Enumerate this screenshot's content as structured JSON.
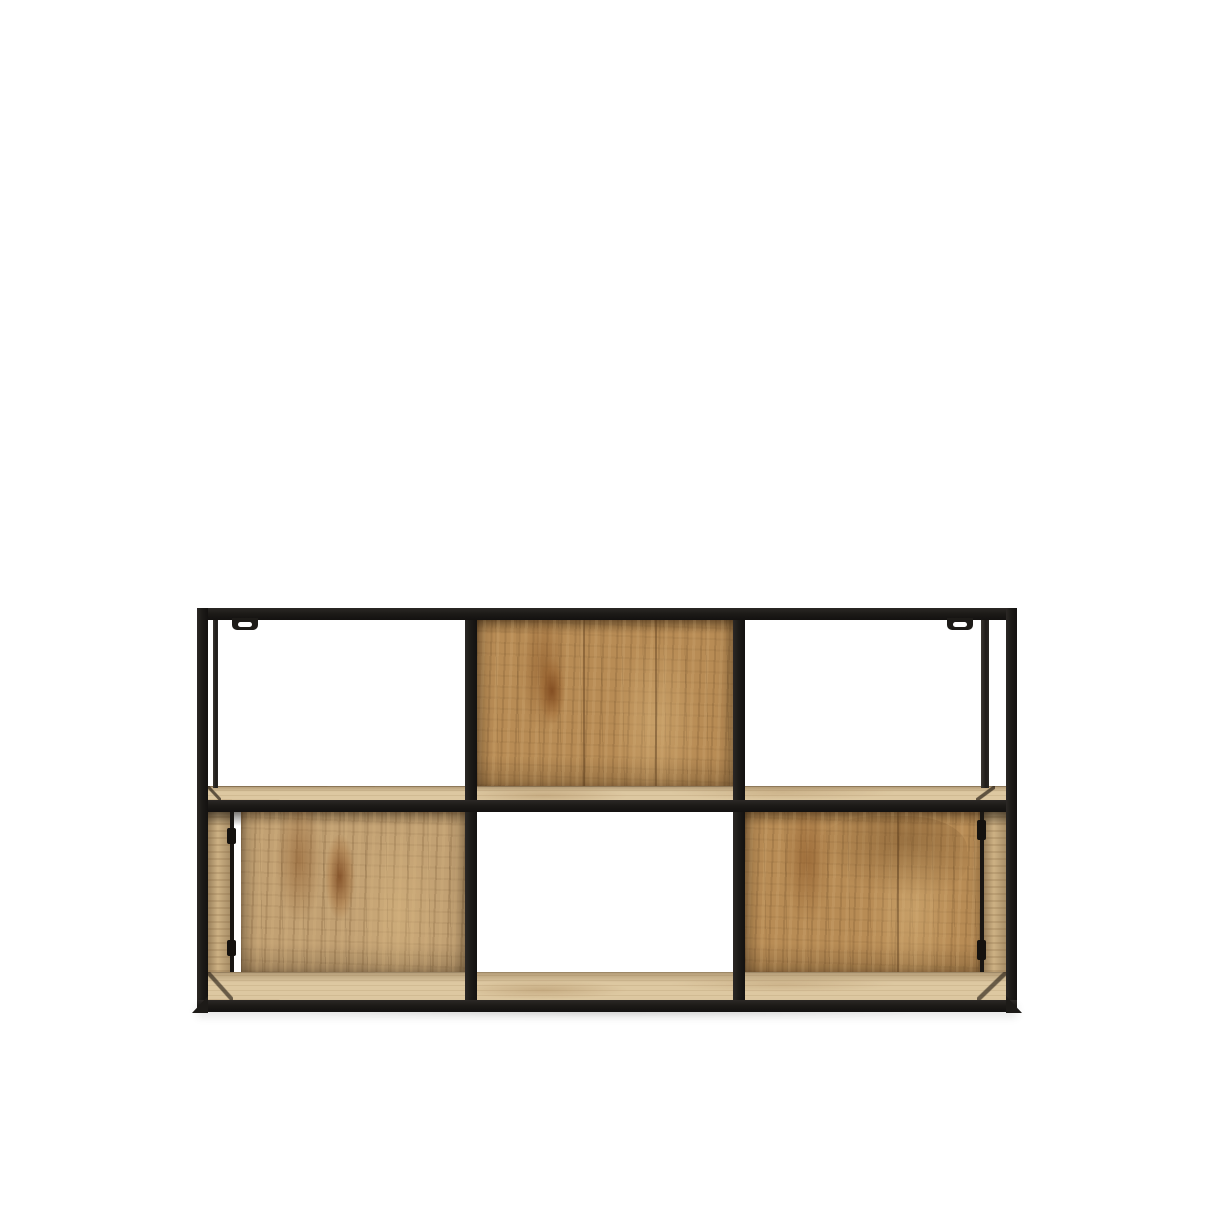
{
  "image": {
    "type": "product-photo",
    "subject": "Industrial wall shelf with black metal frame and mango wood panels",
    "background_color": "#ffffff"
  },
  "shelf": {
    "grid": {
      "columns": 3,
      "rows": 2
    },
    "cells": [
      {
        "row": 1,
        "col": 1,
        "content": "open-compartment"
      },
      {
        "row": 1,
        "col": 2,
        "content": "wood-back-panel"
      },
      {
        "row": 1,
        "col": 3,
        "content": "open-compartment"
      },
      {
        "row": 2,
        "col": 1,
        "content": "wood-box-compartment"
      },
      {
        "row": 2,
        "col": 2,
        "content": "open-compartment-with-wood-base"
      },
      {
        "row": 2,
        "col": 3,
        "content": "wood-box-compartment"
      }
    ],
    "features": [
      "two wall-mount tabs with screw slots on the top rail",
      "hinge fittings on the corner posts of both lower boxes",
      "wood shelf surface between the two rows",
      "wood base panel along the bottom"
    ]
  },
  "colors": {
    "background": "#ffffff",
    "frame_black": "#1d1b18",
    "wood_back_panel": "#b88c55",
    "wood_box_back": "#c2a173",
    "wood_side_panel": "#cdb184",
    "wood_shelf_surface": "#ddc8a1",
    "ground_shadow": "rgba(0,0,0,0.14)"
  }
}
